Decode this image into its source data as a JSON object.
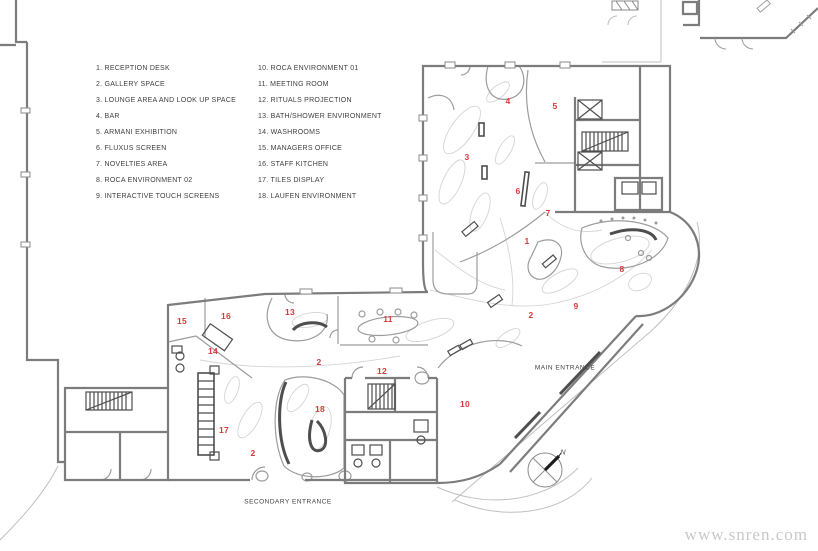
{
  "title": "Gallery floor plan",
  "colors": {
    "wall_gray": "#7c7c7c",
    "medium_gray": "#9c9c9c",
    "light_curve_gray": "#d4d4d4",
    "dark_detail": "#4e4e4e",
    "marker_red": "#d9393b",
    "text_gray": "#3f3f3f",
    "watermark_gray": "#c9c9c9"
  },
  "legend": {
    "column1": [
      {
        "label": "1. RECEPTION DESK"
      },
      {
        "label": "2. GALLERY SPACE"
      },
      {
        "label": "3. LOUNGE AREA AND LOOK UP SPACE"
      },
      {
        "label": "4. BAR"
      },
      {
        "label": "5. ARMANI EXHIBITION"
      },
      {
        "label": "6. FLUXUS SCREEN"
      },
      {
        "label": "7. NOVELTIES AREA"
      },
      {
        "label": "8. ROCA ENVIRONMENT 02"
      },
      {
        "label": "9. INTERACTIVE TOUCH SCREENS"
      }
    ],
    "column2": [
      {
        "label": "10. ROCA ENVIRONMENT 01"
      },
      {
        "label": "11. MEETING ROOM"
      },
      {
        "label": "12. RITUALS PROJECTION"
      },
      {
        "label": "13. BATH/SHOWER ENVIRONMENT"
      },
      {
        "label": "14. WASHROOMS"
      },
      {
        "label": "15. MANAGERS OFFICE"
      },
      {
        "label": "16. STAFF KITCHEN"
      },
      {
        "label": "17. TILES DISPLAY"
      },
      {
        "label": "18. LAUFEN ENVIRONMENT"
      }
    ]
  },
  "plan": {
    "markers": [
      {
        "label": "4",
        "x": 508,
        "y": 101
      },
      {
        "label": "5",
        "x": 555,
        "y": 106
      },
      {
        "label": "3",
        "x": 467,
        "y": 157
      },
      {
        "label": "6",
        "x": 518,
        "y": 191
      },
      {
        "label": "7",
        "x": 548,
        "y": 213
      },
      {
        "label": "1",
        "x": 527,
        "y": 241
      },
      {
        "label": "8",
        "x": 622,
        "y": 269
      },
      {
        "label": "9",
        "x": 576,
        "y": 306
      },
      {
        "label": "2",
        "x": 531,
        "y": 315
      },
      {
        "label": "13",
        "x": 290,
        "y": 312
      },
      {
        "label": "16",
        "x": 226,
        "y": 316
      },
      {
        "label": "11",
        "x": 388,
        "y": 319
      },
      {
        "label": "15",
        "x": 182,
        "y": 321
      },
      {
        "label": "14",
        "x": 213,
        "y": 351
      },
      {
        "label": "2",
        "x": 319,
        "y": 362
      },
      {
        "label": "12",
        "x": 382,
        "y": 371
      },
      {
        "label": "10",
        "x": 465,
        "y": 404
      },
      {
        "label": "18",
        "x": 320,
        "y": 409
      },
      {
        "label": "17",
        "x": 224,
        "y": 430
      },
      {
        "label": "2",
        "x": 253,
        "y": 453
      }
    ],
    "main_entrance_label": "MAIN ENTRANCE",
    "secondary_entrance_label": "SECONDARY ENTRANCE",
    "compass_label": "N"
  },
  "watermark": "www.snren.com"
}
